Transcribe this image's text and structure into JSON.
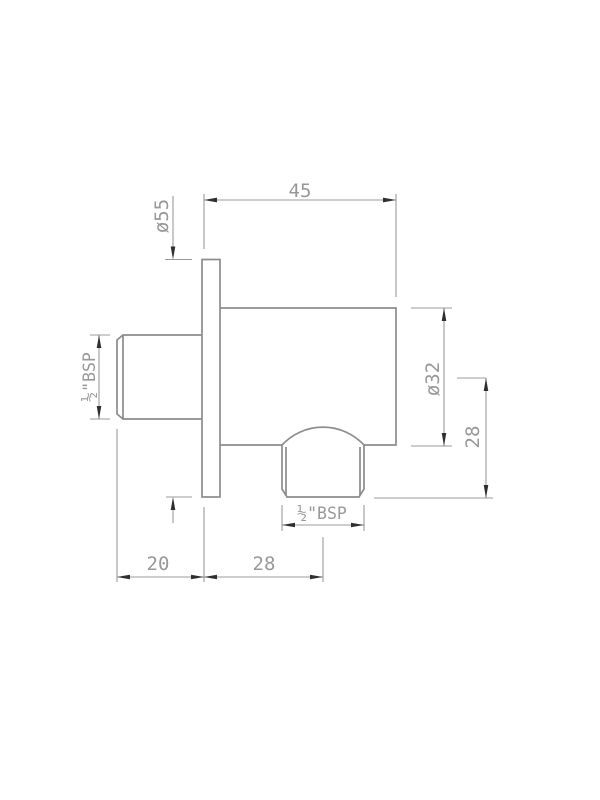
{
  "dimensions": {
    "overall_depth": "45",
    "flange_diameter": "ø55",
    "inlet_thread": "½\"BSP",
    "body_diameter": "ø32",
    "outlet_drop": "28",
    "outlet_thread": "½\"BSP",
    "inlet_length": "20",
    "outlet_center_offset": "28"
  },
  "colors": {
    "background": "#ffffff",
    "outline": "#8c8c8c",
    "dimension_line": "#9b9b9b",
    "dimension_text": "#989898",
    "arrowhead": "#2f2f2f"
  }
}
